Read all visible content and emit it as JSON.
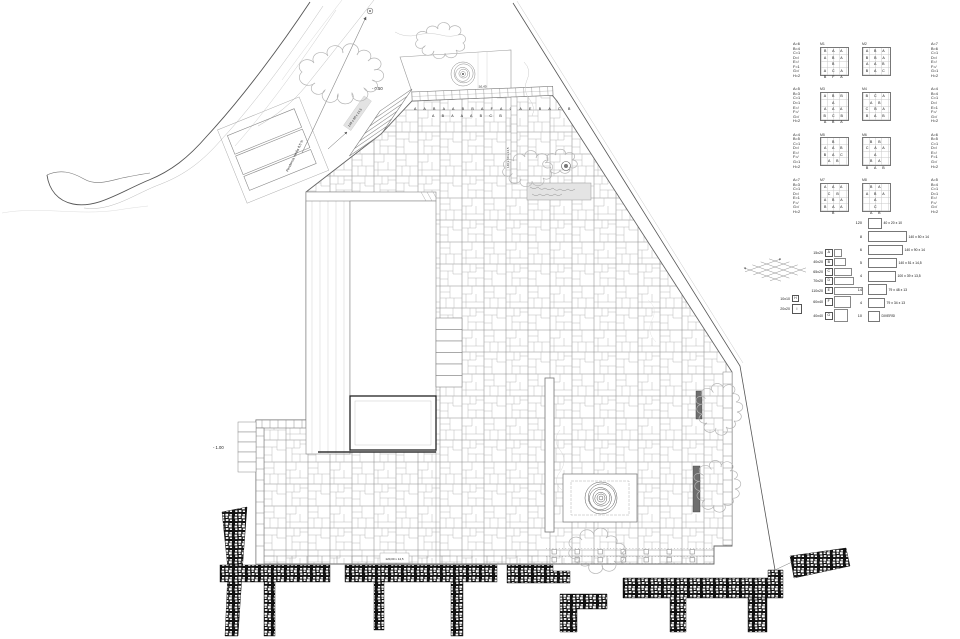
{
  "labels": {
    "slope": "Pendenza media 8,5 %",
    "level_top": "- 0.50",
    "level_left": "- 1.00",
    "stair_dim": "140 x 50 x 14,5",
    "edge_dim": "140 x 50 x 14,5",
    "band_dim": "36,40",
    "letters_row1": "A A B A A B B A F A C A E B A C B",
    "letters_row2": "A B A A A B C B",
    "wall_dim_box": "120,00 x 14,5"
  },
  "legend": {
    "rows": [
      {
        "left_list": "A=6\nB=4\nC=1\nD=/\nE=/\nF=1\nG=/\nH=2",
        "left_id": "M1",
        "left_grid": "B A A\nA B A B\nA C A\nB F A",
        "right_id": "M2",
        "right_grid": "A B A\nB B A\nA A B\nB A C",
        "right_list": "A=7\nB=6\nC=1\nD=/\nE=/\nF=/\nG=1\nH=2"
      },
      {
        "left_list": "A=5\nB=3\nC=1\nD=1\nE=/\nF=/\nG=/\nH=2",
        "left_id": "M3",
        "left_grid": "A B B A\nA A A\nB C B\nA B A",
        "right_id": "M4",
        "right_grid": "B C A\nA B\nC B A\nB A B",
        "right_list": "A=4\nB=4\nC=1\nD=/\nE=1\nF=/\nG=/\nH=2"
      },
      {
        "left_list": "A=4\nB=5\nC=1\nD=/\nE=/\nF=/\nG=1\nH=2",
        "left_id": "M5",
        "left_grid": "B\nA A B\nB A C\nA B",
        "right_id": "M6",
        "right_grid": "B B\nC A A A\nB A\nB A B",
        "right_list": "A=6\nB=5\nC=1\nD=/\nE=/\nF=1\nG=/\nH=2"
      },
      {
        "left_list": "A=7\nB=3\nC=1\nD=/\nE=1\nF=/\nG=/\nH=2",
        "left_id": "M7",
        "left_grid": "A A A\nC B\nA B A\nB A A B",
        "right_id": "M8",
        "right_grid": "B A\nA B A A\nC\nA B",
        "right_list": "A=5\nB=4\nC=1\nD=1\nE=/\nF=/\nG=/\nH=2"
      }
    ]
  },
  "stone_key": {
    "rows": [
      {
        "dim": "15x20",
        "letter": "A",
        "w": "6px",
        "h": "6px"
      },
      {
        "dim": "40x20",
        "letter": "B",
        "w": "10px",
        "h": "6px"
      },
      {
        "dim": "65x20",
        "letter": "C",
        "w": "16px",
        "h": "6px"
      },
      {
        "dim": "70x20",
        "letter": "D",
        "w": "18px",
        "h": "6px"
      },
      {
        "dim": "110x20",
        "letter": "E",
        "w": "27px",
        "h": "6px"
      },
      {
        "dim": "60x40",
        "letter": "F",
        "w": "15px",
        "h": "10px"
      },
      {
        "dim": "40x40",
        "letter": "G",
        "w": "12px",
        "h": "11px"
      }
    ],
    "extras": [
      {
        "dim": "10x10",
        "letter": "H",
        "w": "5px",
        "h": "5px"
      },
      {
        "dim": "20x20",
        "letter": "I",
        "w": "8px",
        "h": "8px"
      }
    ]
  },
  "count_table": {
    "rows": [
      {
        "count": "120",
        "dim": "40 x 20 x 10",
        "w": "12px"
      },
      {
        "count": "8",
        "dim": "140 x 50 x 14",
        "w": "37px"
      },
      {
        "count": "6",
        "dim": "140 x 90 x 14",
        "w": "33px"
      },
      {
        "count": "5",
        "dim": "140 x 51 x 14,5",
        "w": "27px"
      },
      {
        "count": "4",
        "dim": "100 x 39 x 13,5",
        "w": "26px"
      },
      {
        "count": "14",
        "dim": "79 x 48 x 13",
        "w": "17px"
      },
      {
        "count": "4",
        "dim": "79 x 34 x 13",
        "w": "15px"
      },
      {
        "count": "10",
        "dim": "DIVERSI",
        "w": "10px"
      }
    ]
  }
}
